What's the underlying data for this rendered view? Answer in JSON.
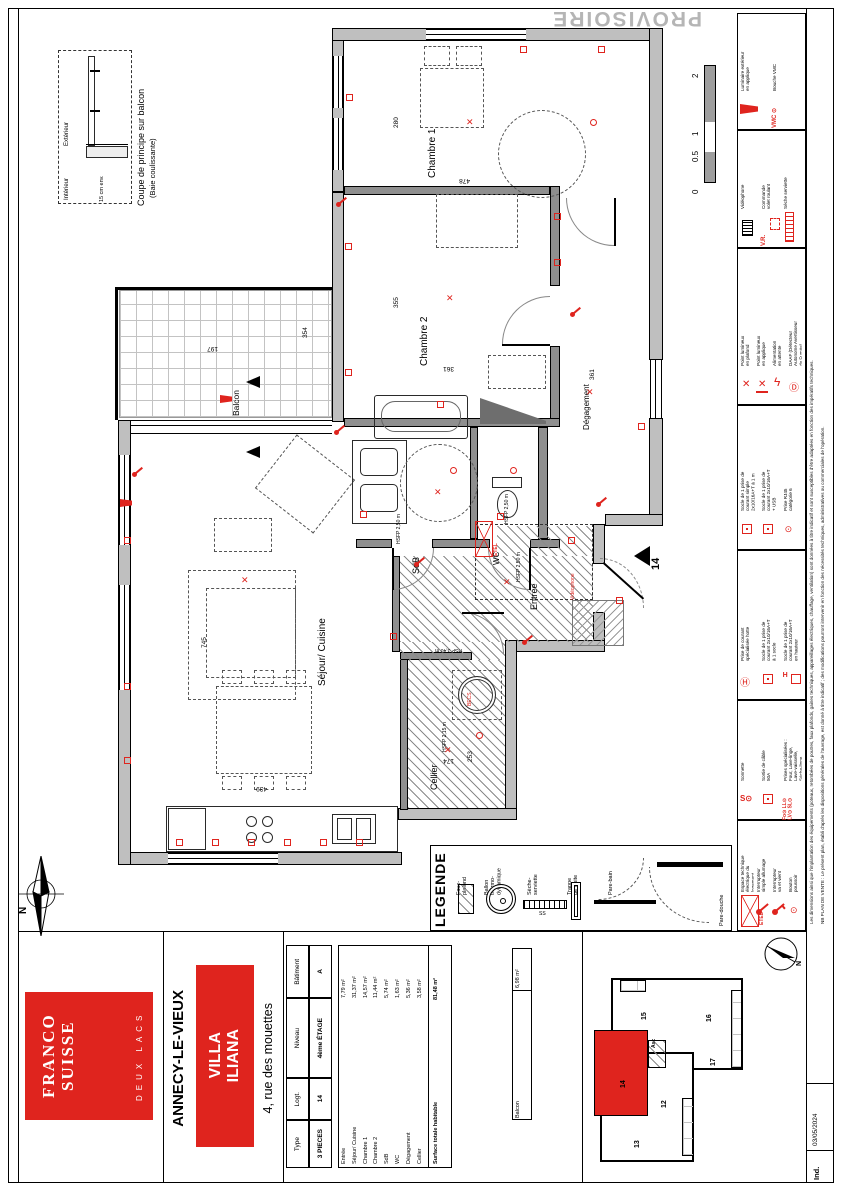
{
  "watermark": "PROVISOIRE",
  "sheet_index": {
    "label": "Ind.",
    "date": "03/05/2024"
  },
  "unit_marker": "14",
  "compass_letter": "N",
  "coupe": {
    "title": "Coupe de principe sur balcon",
    "subtitle": "(Baie coulissante)",
    "exterior": "Extérieur",
    "interior": "Intérieur",
    "dim": "15 cm env."
  },
  "scalebar": {
    "labels": [
      "0",
      "0.5",
      "1",
      "2"
    ]
  },
  "colors": {
    "accent_red": "#df241e",
    "wall_gray": "#bfbfbf",
    "watermark_gray": "#b5b5b5"
  },
  "plan": {
    "rooms": [
      {
        "t": "Chambre 1",
        "x": 427,
        "y": 88,
        "fs": 10
      },
      {
        "t": "Chambre 2",
        "x": 419,
        "y": 276,
        "fs": 10
      },
      {
        "t": "Balcon",
        "x": 232,
        "y": 326,
        "fs": 8.5
      },
      {
        "t": "Séjour/ Cuisine",
        "x": 317,
        "y": 596,
        "fs": 10
      },
      {
        "t": "SdB",
        "x": 411,
        "y": 484,
        "fs": 9
      },
      {
        "t": "WC",
        "x": 493,
        "y": 475,
        "fs": 8
      },
      {
        "t": "Entrée",
        "x": 529,
        "y": 520,
        "fs": 9
      },
      {
        "t": "Dégagement",
        "x": 583,
        "y": 340,
        "fs": 8
      },
      {
        "t": "Cellier",
        "x": 429,
        "y": 700,
        "fs": 9
      }
    ],
    "subtexts": [
      {
        "t": "HSFP 2,50 m",
        "x": 397,
        "y": 498,
        "o": "v"
      },
      {
        "t": "HSFP 2,50 m",
        "x": 505,
        "y": 478,
        "o": "v"
      },
      {
        "t": "HSFP 2,50 m",
        "x": 517,
        "y": 536,
        "o": "v"
      },
      {
        "t": "HSFP 2,15 m",
        "x": 443,
        "y": 706,
        "o": "v"
      },
      {
        "t": "HSP 3,40 m",
        "x": 416,
        "y": 645,
        "o": "h"
      }
    ],
    "dims": [
      {
        "t": "280",
        "x": 393,
        "y": 104,
        "o": "v"
      },
      {
        "t": "355",
        "x": 393,
        "y": 284,
        "o": "v"
      },
      {
        "t": "361",
        "x": 589,
        "y": 356,
        "o": "v"
      },
      {
        "t": "354",
        "x": 302,
        "y": 314,
        "o": "v"
      },
      {
        "t": "745",
        "x": 201,
        "y": 624,
        "o": "v"
      },
      {
        "t": "253",
        "x": 467,
        "y": 738,
        "o": "v"
      },
      {
        "t": "478",
        "x": 446,
        "y": 177,
        "o": "h"
      },
      {
        "t": "361",
        "x": 430,
        "y": 365,
        "o": "h"
      },
      {
        "t": "197",
        "x": 194,
        "y": 345,
        "o": "h"
      },
      {
        "t": "439",
        "x": 243,
        "y": 785,
        "o": "h"
      },
      {
        "t": "174",
        "x": 430,
        "y": 757,
        "o": "h"
      }
    ],
    "symbols": [
      {
        "x": 466,
        "y": 117,
        "t": "x"
      },
      {
        "x": 446,
        "y": 293,
        "t": "x"
      },
      {
        "x": 586,
        "y": 387,
        "t": "x"
      },
      {
        "x": 434,
        "y": 487,
        "t": "x"
      },
      {
        "x": 503,
        "y": 577,
        "t": "x"
      },
      {
        "x": 444,
        "y": 745,
        "t": "x"
      },
      {
        "x": 241,
        "y": 575,
        "t": "x"
      },
      {
        "x": 346,
        "y": 94,
        "t": "sq"
      },
      {
        "x": 520,
        "y": 46,
        "t": "sq"
      },
      {
        "x": 598,
        "y": 46,
        "t": "sq"
      },
      {
        "x": 554,
        "y": 213,
        "t": "sq"
      },
      {
        "x": 554,
        "y": 259,
        "t": "sq"
      },
      {
        "x": 345,
        "y": 243,
        "t": "sq"
      },
      {
        "x": 345,
        "y": 369,
        "t": "sq"
      },
      {
        "x": 124,
        "y": 537,
        "t": "sq"
      },
      {
        "x": 124,
        "y": 683,
        "t": "sq"
      },
      {
        "x": 124,
        "y": 757,
        "t": "sq"
      },
      {
        "x": 176,
        "y": 839,
        "t": "sq"
      },
      {
        "x": 212,
        "y": 839,
        "t": "sq"
      },
      {
        "x": 248,
        "y": 839,
        "t": "sq"
      },
      {
        "x": 284,
        "y": 839,
        "t": "sq"
      },
      {
        "x": 320,
        "y": 839,
        "t": "sq"
      },
      {
        "x": 356,
        "y": 839,
        "t": "sq"
      },
      {
        "x": 390,
        "y": 633,
        "t": "sq"
      },
      {
        "x": 497,
        "y": 513,
        "t": "sq"
      },
      {
        "x": 568,
        "y": 537,
        "t": "sq"
      },
      {
        "x": 616,
        "y": 597,
        "t": "sq"
      },
      {
        "x": 638,
        "y": 423,
        "t": "sq"
      },
      {
        "x": 360,
        "y": 511,
        "t": "sq"
      },
      {
        "x": 437,
        "y": 401,
        "t": "sq"
      },
      {
        "x": 570,
        "y": 305,
        "t": "sw"
      },
      {
        "x": 596,
        "y": 495,
        "t": "sw"
      },
      {
        "x": 414,
        "y": 555,
        "t": "sw"
      },
      {
        "x": 132,
        "y": 465,
        "t": "sw"
      },
      {
        "x": 336,
        "y": 195,
        "t": "sw"
      },
      {
        "x": 522,
        "y": 633,
        "t": "sw"
      },
      {
        "x": 334,
        "y": 423,
        "t": "sw"
      },
      {
        "x": 220,
        "y": 395,
        "t": "tri"
      },
      {
        "x": 120,
        "y": 499,
        "t": "tri"
      },
      {
        "x": 510,
        "y": 467,
        "t": "c"
      },
      {
        "x": 450,
        "y": 467,
        "t": "c"
      },
      {
        "x": 476,
        "y": 732,
        "t": "c"
      },
      {
        "x": 590,
        "y": 119,
        "t": "c"
      }
    ],
    "videophone_label": "Vidéophone",
    "etel_label": "ETEL",
    "becs_label": "BECS"
  },
  "legende": {
    "title": "LEGENDE",
    "ss": "SS",
    "items": [
      {
        "label": "Faux-\nplafond",
        "x": 456,
        "sym": "hatch"
      },
      {
        "label": "Ballon\nthermo-\ndynamique",
        "x": 484,
        "sym": "ballon"
      },
      {
        "label": "Sèche-\nserviette",
        "x": 527,
        "sym": "radh"
      },
      {
        "label": "Trappe\nde visite",
        "x": 567,
        "sym": "trappe"
      },
      {
        "label": "Pare-bain",
        "x": 608,
        "sym": "parebain"
      },
      {
        "label": "Pare-douche",
        "x": 719,
        "sym": "paredouche"
      }
    ]
  },
  "electrical_legend": {
    "sections": [
      {
        "items": [
          {
            "s": "sconce",
            "l": "Luminaire extérieur\nen applique"
          },
          {
            "s": "vmc",
            "l": "Bouche VMC"
          }
        ]
      },
      {
        "items": [
          {
            "s": "video",
            "l": "Vidéophone"
          },
          {
            "s": "vr",
            "l": "Commande\nvolet roulant"
          },
          {
            "s": "rad",
            "l": "Sèche serviette"
          }
        ]
      },
      {
        "items": [
          {
            "s": "xc",
            "l": "Point lumineux\nen plafond"
          },
          {
            "s": "xa",
            "l": "Point lumineux\nen applique"
          },
          {
            "s": "bolt",
            "l": "Alimentation\nen attente"
          },
          {
            "s": "daaf",
            "l": "DAAF (Détecteur\nAutonome Avertisseur\nde Fumée)"
          }
        ]
      },
      {
        "items": [
          {
            "s": "sq2",
            "l": "Socle de 1 prise de\ncourant simple\n2x10/16A+T à 1 m"
          },
          {
            "s": "sq2",
            "l": "Socle de 1 prise de\ncourant 2x10/16A+T\n+ USB"
          },
          {
            "s": "rj",
            "l": "Prise RJ45\ncatégorie 6"
          }
        ]
      },
      {
        "items": [
          {
            "s": "hotte",
            "l": "Prise de courant\nspécialisée hotte"
          },
          {
            "s": "sq2",
            "l": "Socle de 1 prise de\ncourant 2x10/16A+T\nà 1 socle"
          },
          {
            "s": "sqh",
            "l": "Socle de 1 prise de\ncourant 2x10/16A+T\nen hauteur"
          }
        ]
      },
      {
        "items": [
          {
            "s": "son",
            "l": "Sonnette"
          },
          {
            "s": "der",
            "l": "Sortie de câble\n50A"
          },
          {
            "s": "grp",
            "l": "Prises spécialisées :\nFour, Lave-linge,\nLave-vaisselle,\nSèche-linge"
          }
        ]
      },
      {
        "items": [
          {
            "s": "etel",
            "l": "Espace technique\nélectrique du\nlogement"
          },
          {
            "s": "int1",
            "l": "Interrupteur\nsimple allumage"
          },
          {
            "s": "int2",
            "l": "Interrupteur\nva et vient"
          },
          {
            "s": "bp",
            "l": "Bouton\npoussoir"
          }
        ]
      }
    ],
    "disclaimer1": "Les dimensions ainsi que l'implantation des équipements (poteaux, retombées de poutres, faux plafonds, gaines techniques, appareillages électriques, chauffage, ventilation) sont données à titre indicatif et sont susceptibles d'être adaptées en fonction des impératifs techniques.",
    "disclaimer2": "NB PLAN DE VENTE : Le présent plan, établi d'après les dispositions générales de l'ouvrage, est donné à titre indicatif ; des modifications pourront intervenir en fonction des nécessités techniques, administratives ou commerciales de l'opération."
  },
  "title_block": {
    "brand": {
      "line1": "FRANCO",
      "line2": "SUISSE",
      "sub": "DEUX LACS"
    },
    "city": "ANNECY-LE-VIEUX",
    "residence": "VILLA\nILIANA",
    "address": "4, rue des mouettes",
    "info": {
      "headers": [
        "Type",
        "Logt.",
        "Niveau",
        "Bâtiment"
      ],
      "values": [
        "3 PIECES",
        "14",
        "4ème ÉTAGE",
        "A"
      ]
    },
    "areas": {
      "rows": [
        {
          "name": "Entrée",
          "val": "7,79 m²"
        },
        {
          "name": "Séjour/ Cuisine",
          "val": "31,37 m²"
        },
        {
          "name": "Chambre 1",
          "val": "14,57 m²"
        },
        {
          "name": "Chambre 2",
          "val": "11,44 m²"
        },
        {
          "name": "SdB",
          "val": "5,74 m²"
        },
        {
          "name": "WC",
          "val": "1,63 m²"
        },
        {
          "name": "Dégagement",
          "val": "5,36 m²"
        },
        {
          "name": "Cellier",
          "val": "3,58 m²"
        }
      ],
      "total_name": "Surface totale habitable",
      "total_val": "81,48 m²",
      "balcon_name": "Balcon",
      "balcon_val": "6,98 m²"
    }
  },
  "key_plan": {
    "units": [
      {
        "t": "15",
        "x": 641,
        "y": 998
      },
      {
        "t": "16",
        "x": 706,
        "y": 1000
      },
      {
        "t": "17",
        "x": 710,
        "y": 1044
      },
      {
        "t": "12",
        "x": 661,
        "y": 1086
      },
      {
        "t": "13",
        "x": 634,
        "y": 1126
      },
      {
        "t": "14",
        "x": 620,
        "y": 1066
      },
      {
        "t": "Asc",
        "x": 652,
        "y": 1026
      }
    ],
    "compass_letter": "N"
  }
}
